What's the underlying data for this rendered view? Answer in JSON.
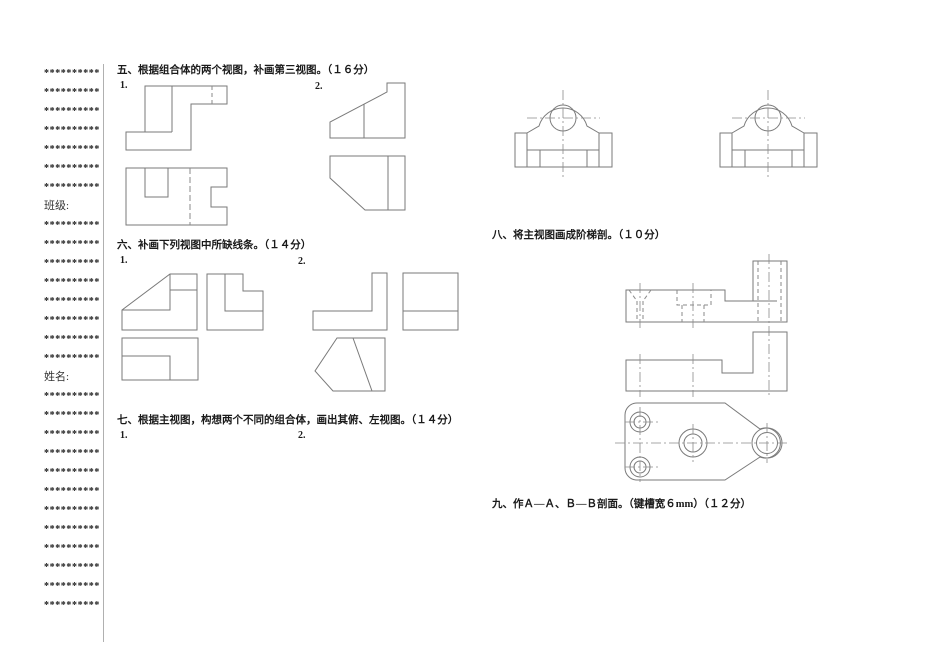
{
  "margin": {
    "star_row": "**********",
    "class_label": "班级:",
    "name_label": "姓名:",
    "rows_before_class": 7,
    "rows_between_labels": 8,
    "rows_after_name": 12
  },
  "questions": {
    "q5": {
      "title": "五、根据组合体的两个视图，补画第三视图。（１６分）",
      "item1": "1.",
      "item2": "2."
    },
    "q6": {
      "title": "六、补画下列视图中所缺线条。（１４分）",
      "item1": "1.",
      "item2": "2."
    },
    "q7": {
      "title": "七、根据主视图，构想两个不同的组合体，画出其俯、左视图。（１４分）",
      "item1": "1.",
      "item2": "2."
    },
    "q8": {
      "title": "八、将主视图画成阶梯剖。（１０分）"
    },
    "q9": {
      "title": "九、作Ａ—Ａ、Ｂ—Ｂ剖面。（键槽宽６mm）（１２分）"
    }
  },
  "colors": {
    "paper": "#ffffff",
    "drawing_line": "#7a7a7a",
    "text": "#1a1a1a"
  }
}
